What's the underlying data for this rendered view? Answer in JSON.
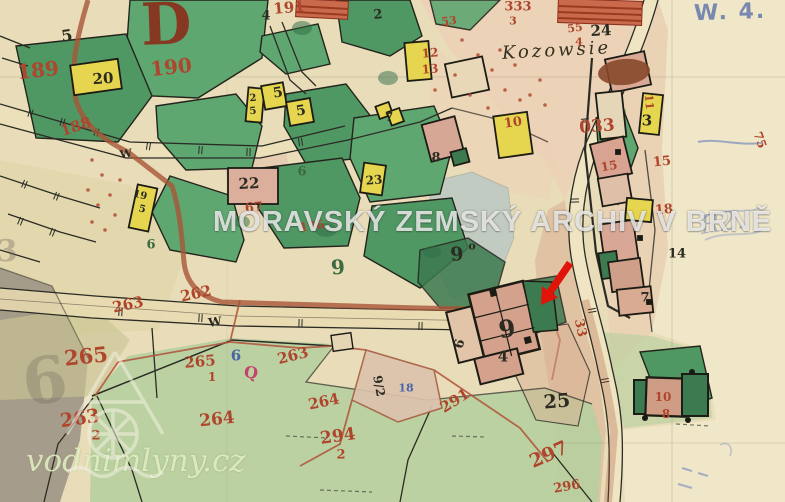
{
  "map": {
    "type": "historical cadastral map scan",
    "section_letter": "D",
    "place_name": "Kozowsie"
  },
  "watermarks": {
    "archive": "MORAVSKÝ ZEMSKÝ ARCHIV V BRNĚ",
    "site": "vodnimlyny.cz"
  },
  "annotations": {
    "registry_mark": "W. 4.",
    "pencil_note": "R2.",
    "arrow_color": "#e01408"
  },
  "palette": {
    "paper": "#e9ddb9",
    "paper-light": "#f0e7c9",
    "green-parcel": "#5fa771",
    "green-parcel-2": "#4f9763",
    "green-dark": "#3c7a50",
    "yellow-building": "#e6d54e",
    "pink-building": "#d8a492",
    "meadow": "#b5cf9e",
    "pond": "#b9c7c3",
    "road-red": "#a85638",
    "ink-red": "#ae452c",
    "ink-black": "#2b2b22",
    "ink-blue": "#4a64a8",
    "ink-green": "#3c6b40",
    "ink-pink": "#c4416b",
    "ink-darkred": "#8a2f1c",
    "ink-pencil": "#6b655c"
  },
  "labels": [
    {
      "t": "189",
      "x": 38,
      "y": 70,
      "s": 20,
      "r": -6,
      "c": "red"
    },
    {
      "t": "190",
      "x": 171,
      "y": 67,
      "s": 20,
      "r": -6,
      "c": "red"
    },
    {
      "t": "188",
      "x": 76,
      "y": 127,
      "s": 15,
      "r": -18,
      "c": "red"
    },
    {
      "t": "191",
      "x": 289,
      "y": 8,
      "s": 15,
      "r": -5,
      "c": "red"
    },
    {
      "t": "333",
      "x": 518,
      "y": 7,
      "s": 13,
      "r": 0,
      "c": "red"
    },
    {
      "t": "3",
      "x": 513,
      "y": 21,
      "s": 11,
      "r": 0,
      "c": "red"
    },
    {
      "t": "53",
      "x": 449,
      "y": 21,
      "s": 11,
      "r": -6,
      "c": "red"
    },
    {
      "t": "55",
      "x": 575,
      "y": 28,
      "s": 11,
      "r": -8,
      "c": "red"
    },
    {
      "t": "4",
      "x": 579,
      "y": 42,
      "s": 11,
      "r": 0,
      "c": "red"
    },
    {
      "t": "033",
      "x": 597,
      "y": 127,
      "s": 17,
      "r": -4,
      "c": "red"
    },
    {
      "t": "12",
      "x": 430,
      "y": 53,
      "s": 12,
      "r": -5,
      "c": "red"
    },
    {
      "t": "13",
      "x": 430,
      "y": 69,
      "s": 12,
      "r": -5,
      "c": "red"
    },
    {
      "t": "10",
      "x": 513,
      "y": 123,
      "s": 13,
      "r": -8,
      "c": "red"
    },
    {
      "t": "15",
      "x": 609,
      "y": 166,
      "s": 12,
      "r": -10,
      "c": "red"
    },
    {
      "t": "15",
      "x": 662,
      "y": 162,
      "s": 13,
      "r": -6,
      "c": "red"
    },
    {
      "t": "18",
      "x": 664,
      "y": 210,
      "s": 13,
      "r": -5,
      "c": "red"
    },
    {
      "t": "67",
      "x": 254,
      "y": 208,
      "s": 13,
      "r": -5,
      "c": "red"
    },
    {
      "t": "176",
      "x": 312,
      "y": 226,
      "s": 12,
      "r": -8,
      "c": "red"
    },
    {
      "t": "262",
      "x": 196,
      "y": 294,
      "s": 15,
      "r": -12,
      "c": "red"
    },
    {
      "t": "263",
      "x": 128,
      "y": 305,
      "s": 15,
      "r": -12,
      "c": "red"
    },
    {
      "t": "265",
      "x": 86,
      "y": 356,
      "s": 21,
      "r": -6,
      "c": "red"
    },
    {
      "t": "265",
      "x": 200,
      "y": 362,
      "s": 15,
      "r": -5,
      "c": "red"
    },
    {
      "t": "1",
      "x": 212,
      "y": 377,
      "s": 12,
      "r": 0,
      "c": "red"
    },
    {
      "t": "263",
      "x": 80,
      "y": 419,
      "s": 19,
      "r": -8,
      "c": "red"
    },
    {
      "t": "2",
      "x": 96,
      "y": 436,
      "s": 13,
      "r": 0,
      "c": "red"
    },
    {
      "t": "264",
      "x": 217,
      "y": 420,
      "s": 17,
      "r": -6,
      "c": "red"
    },
    {
      "t": "263",
      "x": 293,
      "y": 356,
      "s": 15,
      "r": -14,
      "c": "red"
    },
    {
      "t": "264",
      "x": 324,
      "y": 402,
      "s": 15,
      "r": -12,
      "c": "red"
    },
    {
      "t": "294",
      "x": 338,
      "y": 437,
      "s": 17,
      "r": -8,
      "c": "red"
    },
    {
      "t": "2",
      "x": 341,
      "y": 455,
      "s": 13,
      "r": 0,
      "c": "red"
    },
    {
      "t": "291",
      "x": 455,
      "y": 401,
      "s": 15,
      "r": -32,
      "c": "red"
    },
    {
      "t": "297",
      "x": 549,
      "y": 455,
      "s": 19,
      "r": -24,
      "c": "red"
    },
    {
      "t": "296",
      "x": 567,
      "y": 487,
      "s": 13,
      "r": -10,
      "c": "red"
    },
    {
      "t": "10",
      "x": 663,
      "y": 397,
      "s": 12,
      "r": 0,
      "c": "red"
    },
    {
      "t": "8",
      "x": 666,
      "y": 414,
      "s": 12,
      "r": 0,
      "c": "red"
    },
    {
      "t": "33",
      "x": 580,
      "y": 328,
      "s": 13,
      "r": 78,
      "c": "red"
    },
    {
      "t": "11",
      "x": 649,
      "y": 102,
      "s": 11,
      "r": 85,
      "c": "red"
    },
    {
      "t": "75",
      "x": 760,
      "y": 140,
      "s": 12,
      "r": 70,
      "c": "red"
    },
    {
      "t": "5",
      "x": 67,
      "y": 36,
      "s": 16,
      "r": -8,
      "c": "black"
    },
    {
      "t": "20",
      "x": 103,
      "y": 79,
      "s": 15,
      "r": -4,
      "c": "black"
    },
    {
      "t": "22",
      "x": 249,
      "y": 184,
      "s": 15,
      "r": -3,
      "c": "black"
    },
    {
      "t": "24",
      "x": 601,
      "y": 31,
      "s": 15,
      "r": -3,
      "c": "black"
    },
    {
      "t": "4",
      "x": 266,
      "y": 16,
      "s": 13,
      "r": 0,
      "c": "black"
    },
    {
      "t": "2",
      "x": 378,
      "y": 15,
      "s": 13,
      "r": -5,
      "c": "black"
    },
    {
      "t": "5",
      "x": 278,
      "y": 93,
      "s": 14,
      "r": -10,
      "c": "black"
    },
    {
      "t": "5",
      "x": 301,
      "y": 111,
      "s": 14,
      "r": -10,
      "c": "black"
    },
    {
      "t": "7",
      "x": 389,
      "y": 117,
      "s": 12,
      "r": 0,
      "c": "black"
    },
    {
      "t": "8",
      "x": 436,
      "y": 158,
      "s": 13,
      "r": 0,
      "c": "black"
    },
    {
      "t": "23",
      "x": 374,
      "y": 180,
      "s": 12,
      "r": -5,
      "c": "black"
    },
    {
      "t": "9",
      "x": 507,
      "y": 329,
      "s": 24,
      "r": -8,
      "c": "black"
    },
    {
      "t": "4",
      "x": 503,
      "y": 357,
      "s": 15,
      "r": 0,
      "c": "black"
    },
    {
      "t": "6",
      "x": 460,
      "y": 344,
      "s": 13,
      "r": -75,
      "c": "black"
    },
    {
      "t": "25",
      "x": 557,
      "y": 402,
      "s": 19,
      "r": -5,
      "c": "black"
    },
    {
      "t": "14",
      "x": 677,
      "y": 254,
      "s": 13,
      "r": 0,
      "c": "black"
    },
    {
      "t": "3",
      "x": 647,
      "y": 121,
      "s": 15,
      "r": 0,
      "c": "black"
    },
    {
      "t": "7",
      "x": 645,
      "y": 298,
      "s": 13,
      "r": 0,
      "c": "black"
    },
    {
      "t": "9",
      "x": 457,
      "y": 255,
      "s": 19,
      "r": -5,
      "c": "black"
    },
    {
      "t": "o",
      "x": 472,
      "y": 246,
      "s": 11,
      "r": 0,
      "c": "black"
    },
    {
      "t": "19",
      "x": 140,
      "y": 196,
      "s": 10,
      "r": 14,
      "c": "black"
    },
    {
      "t": "5",
      "x": 142,
      "y": 210,
      "s": 10,
      "r": 14,
      "c": "black"
    },
    {
      "t": "2",
      "x": 253,
      "y": 99,
      "s": 10,
      "r": -5,
      "c": "black"
    },
    {
      "t": "5",
      "x": 253,
      "y": 112,
      "s": 10,
      "r": -5,
      "c": "black"
    },
    {
      "t": "W",
      "x": 215,
      "y": 322,
      "s": 12,
      "r": -8,
      "c": "black"
    },
    {
      "t": "W",
      "x": 126,
      "y": 154,
      "s": 11,
      "r": -10,
      "c": "black"
    },
    {
      "t": "9/2",
      "x": 379,
      "y": 386,
      "s": 12,
      "r": 80,
      "c": "black"
    },
    {
      "t": "9",
      "x": 338,
      "y": 267,
      "s": 20,
      "r": -5,
      "c": "green"
    },
    {
      "t": "6",
      "x": 302,
      "y": 172,
      "s": 13,
      "r": 0,
      "c": "green"
    },
    {
      "t": "6",
      "x": 151,
      "y": 245,
      "s": 13,
      "r": 0,
      "c": "green"
    },
    {
      "t": "6",
      "x": 236,
      "y": 356,
      "s": 15,
      "r": 0,
      "c": "blue"
    },
    {
      "t": "18",
      "x": 406,
      "y": 388,
      "s": 11,
      "r": 0,
      "c": "blue"
    },
    {
      "t": "Q",
      "x": 251,
      "y": 373,
      "s": 16,
      "r": 10,
      "c": "pink"
    },
    {
      "t": "6",
      "x": 45,
      "y": 382,
      "s": 64,
      "r": -8,
      "c": "pencil",
      "o": 0.3
    },
    {
      "t": "3",
      "x": 7,
      "y": 252,
      "s": 30,
      "r": 0,
      "c": "pencil",
      "o": 0.35
    }
  ]
}
